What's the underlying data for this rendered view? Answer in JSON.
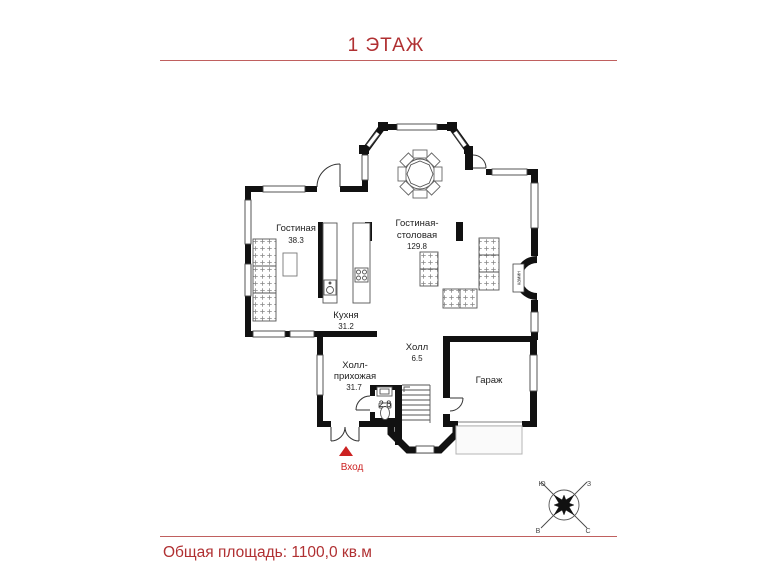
{
  "title": {
    "text": "1 ЭТАЖ"
  },
  "footer": {
    "text": "Общая площадь: 1100,0 кв.м"
  },
  "rooms": {
    "living": {
      "name": "Гостиная",
      "area": "38.3"
    },
    "dining": {
      "line1": "Гостиная-",
      "line2": "столовая",
      "area": "129.8"
    },
    "kitchen": {
      "name": "Кухня",
      "area": "31.2"
    },
    "hall": {
      "name": "Холл",
      "area": "6.5"
    },
    "entry": {
      "line1": "Холл-",
      "line2": "прихожая",
      "area": "31.7"
    },
    "wc": {
      "area": "2.8"
    },
    "garage": {
      "name": "Гараж"
    },
    "fireplace": {
      "name": "камин"
    }
  },
  "entrance": {
    "label": "Вход"
  },
  "compass": {
    "top_left": "Ю",
    "top_right": "З",
    "bottom_left": "В",
    "bottom_right": "С"
  },
  "colors": {
    "accent_text": "#b03032",
    "accent_line": "#c0605f",
    "entrance": "#cc2222",
    "walls": "#111111"
  }
}
